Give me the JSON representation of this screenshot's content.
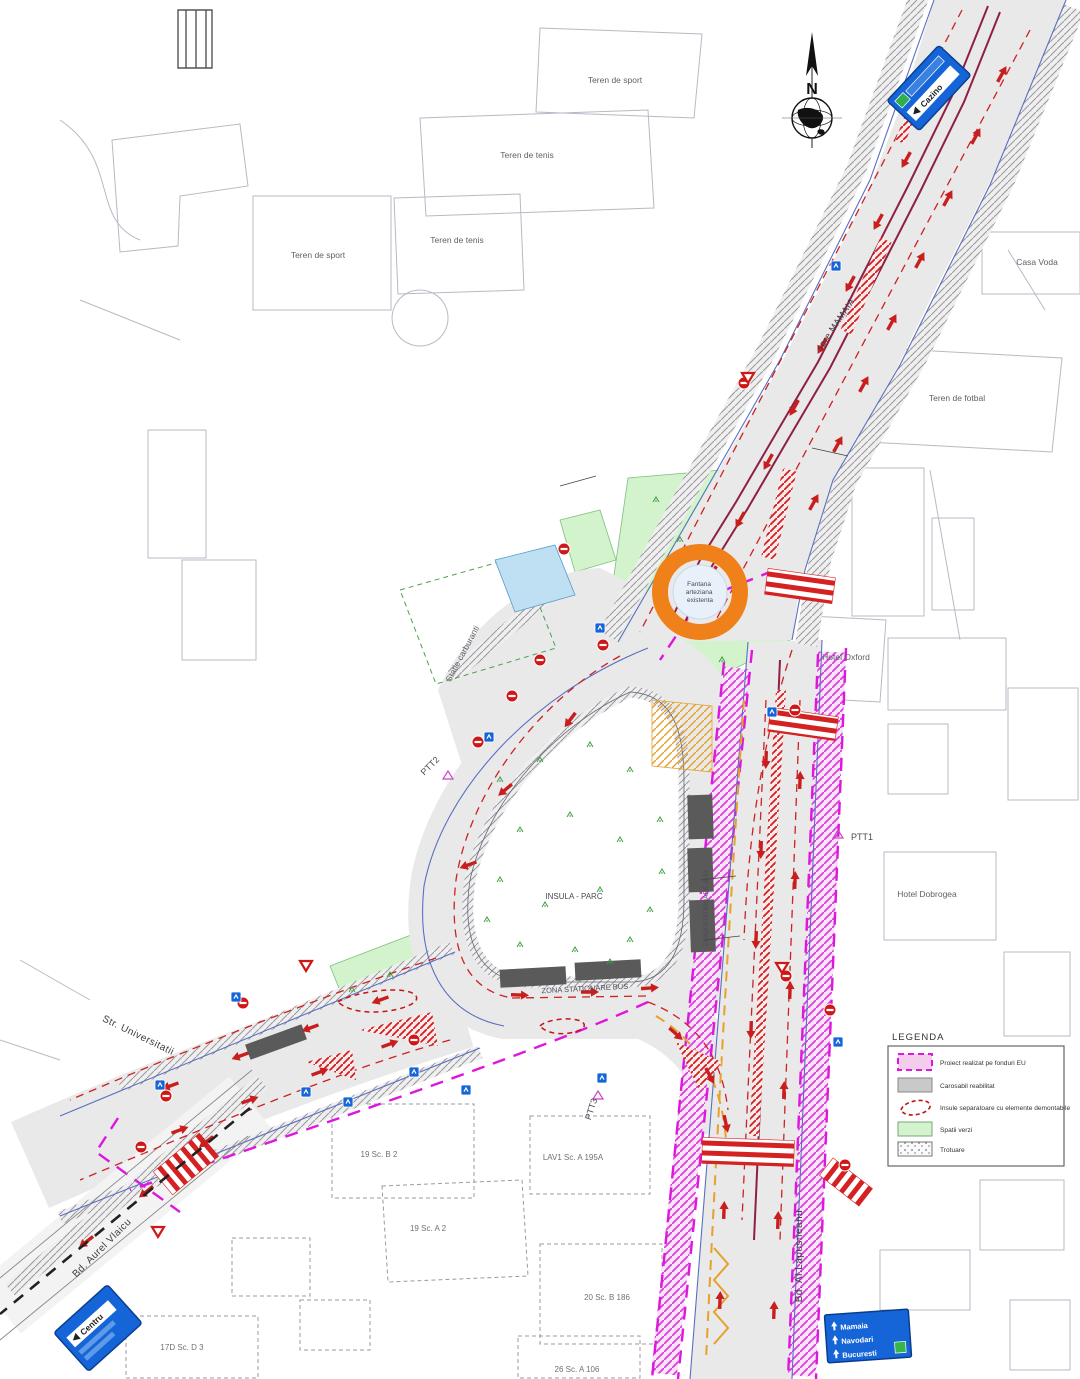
{
  "title": "Plan rutier intersectie - proiect semnalizare",
  "legend": {
    "title": "LEGENDA",
    "items": [
      {
        "swatch": "eu-project",
        "label": "Proiect realizat pe fonduri EU"
      },
      {
        "swatch": "carriageway",
        "label": "Carosabil reabilitat"
      },
      {
        "swatch": "islands",
        "label": "Insule separatoare cu elemente demontabile"
      },
      {
        "swatch": "green",
        "label": "Spatii verzi"
      },
      {
        "swatch": "sidewalk",
        "label": "Trotuare"
      }
    ]
  },
  "compass": {
    "north_label": "N"
  },
  "signs": {
    "top_right_destination": "Cazino",
    "bottom_left_destination": "Centru",
    "bottom_right_lines": [
      "Mamaia",
      "Navodari",
      "Bucuresti"
    ]
  },
  "labels": {
    "teren_sport_top": "Teren de sport",
    "teren_tenis_top": "Teren de tenis",
    "teren_tenis_mid": "Teren de tenis",
    "teren_sport_left": "Teren de sport",
    "casa_voda": "Casa Voda",
    "teren_fotbal": "Teren de fotbal",
    "hotel_oxford": "Hotel Oxford",
    "hotel_dobrogea": "Hotel Dobrogea",
    "statie_carburanti": "Statie carburanti",
    "spre_mamaia": "spre MAMAIA",
    "ptt1": "PTT1",
    "ptt2": "PTT2",
    "ptt3": "PTT3",
    "insula_parc": "INSULA - PARC",
    "zona_stationare_bus": "ZONA STATIONARE BUS",
    "zona_stationare_bus_vertical": "ZONA STATIONARE BUS",
    "str_universitatii": "Str. Universitatii",
    "bd_aurel_vlaicu": "Bd. Aurel Vlaicu",
    "bd_al_lapusneanu": "Bd. Al.Lapusneanu",
    "fountain_line1": "Fantana",
    "fountain_line2": "arteziana",
    "fountain_line3": "existenta",
    "block_19b": "19 Sc. B 2",
    "block_19a": "19 Sc. A 2",
    "block_lav1": "LAV1 Sc. A 195A",
    "block_20b": "20 Sc. B 186",
    "block_26a": "26 Sc. A 106",
    "block_17d": "17D Sc. D 3"
  },
  "colors": {
    "road": "#e9e9ea",
    "green_area": "#d2f3cb",
    "magenta_project": "#dd17dd",
    "red_marking": "#cc1e1e",
    "blue_sign": "#1565d8",
    "fountain_orange": "#f08019"
  }
}
